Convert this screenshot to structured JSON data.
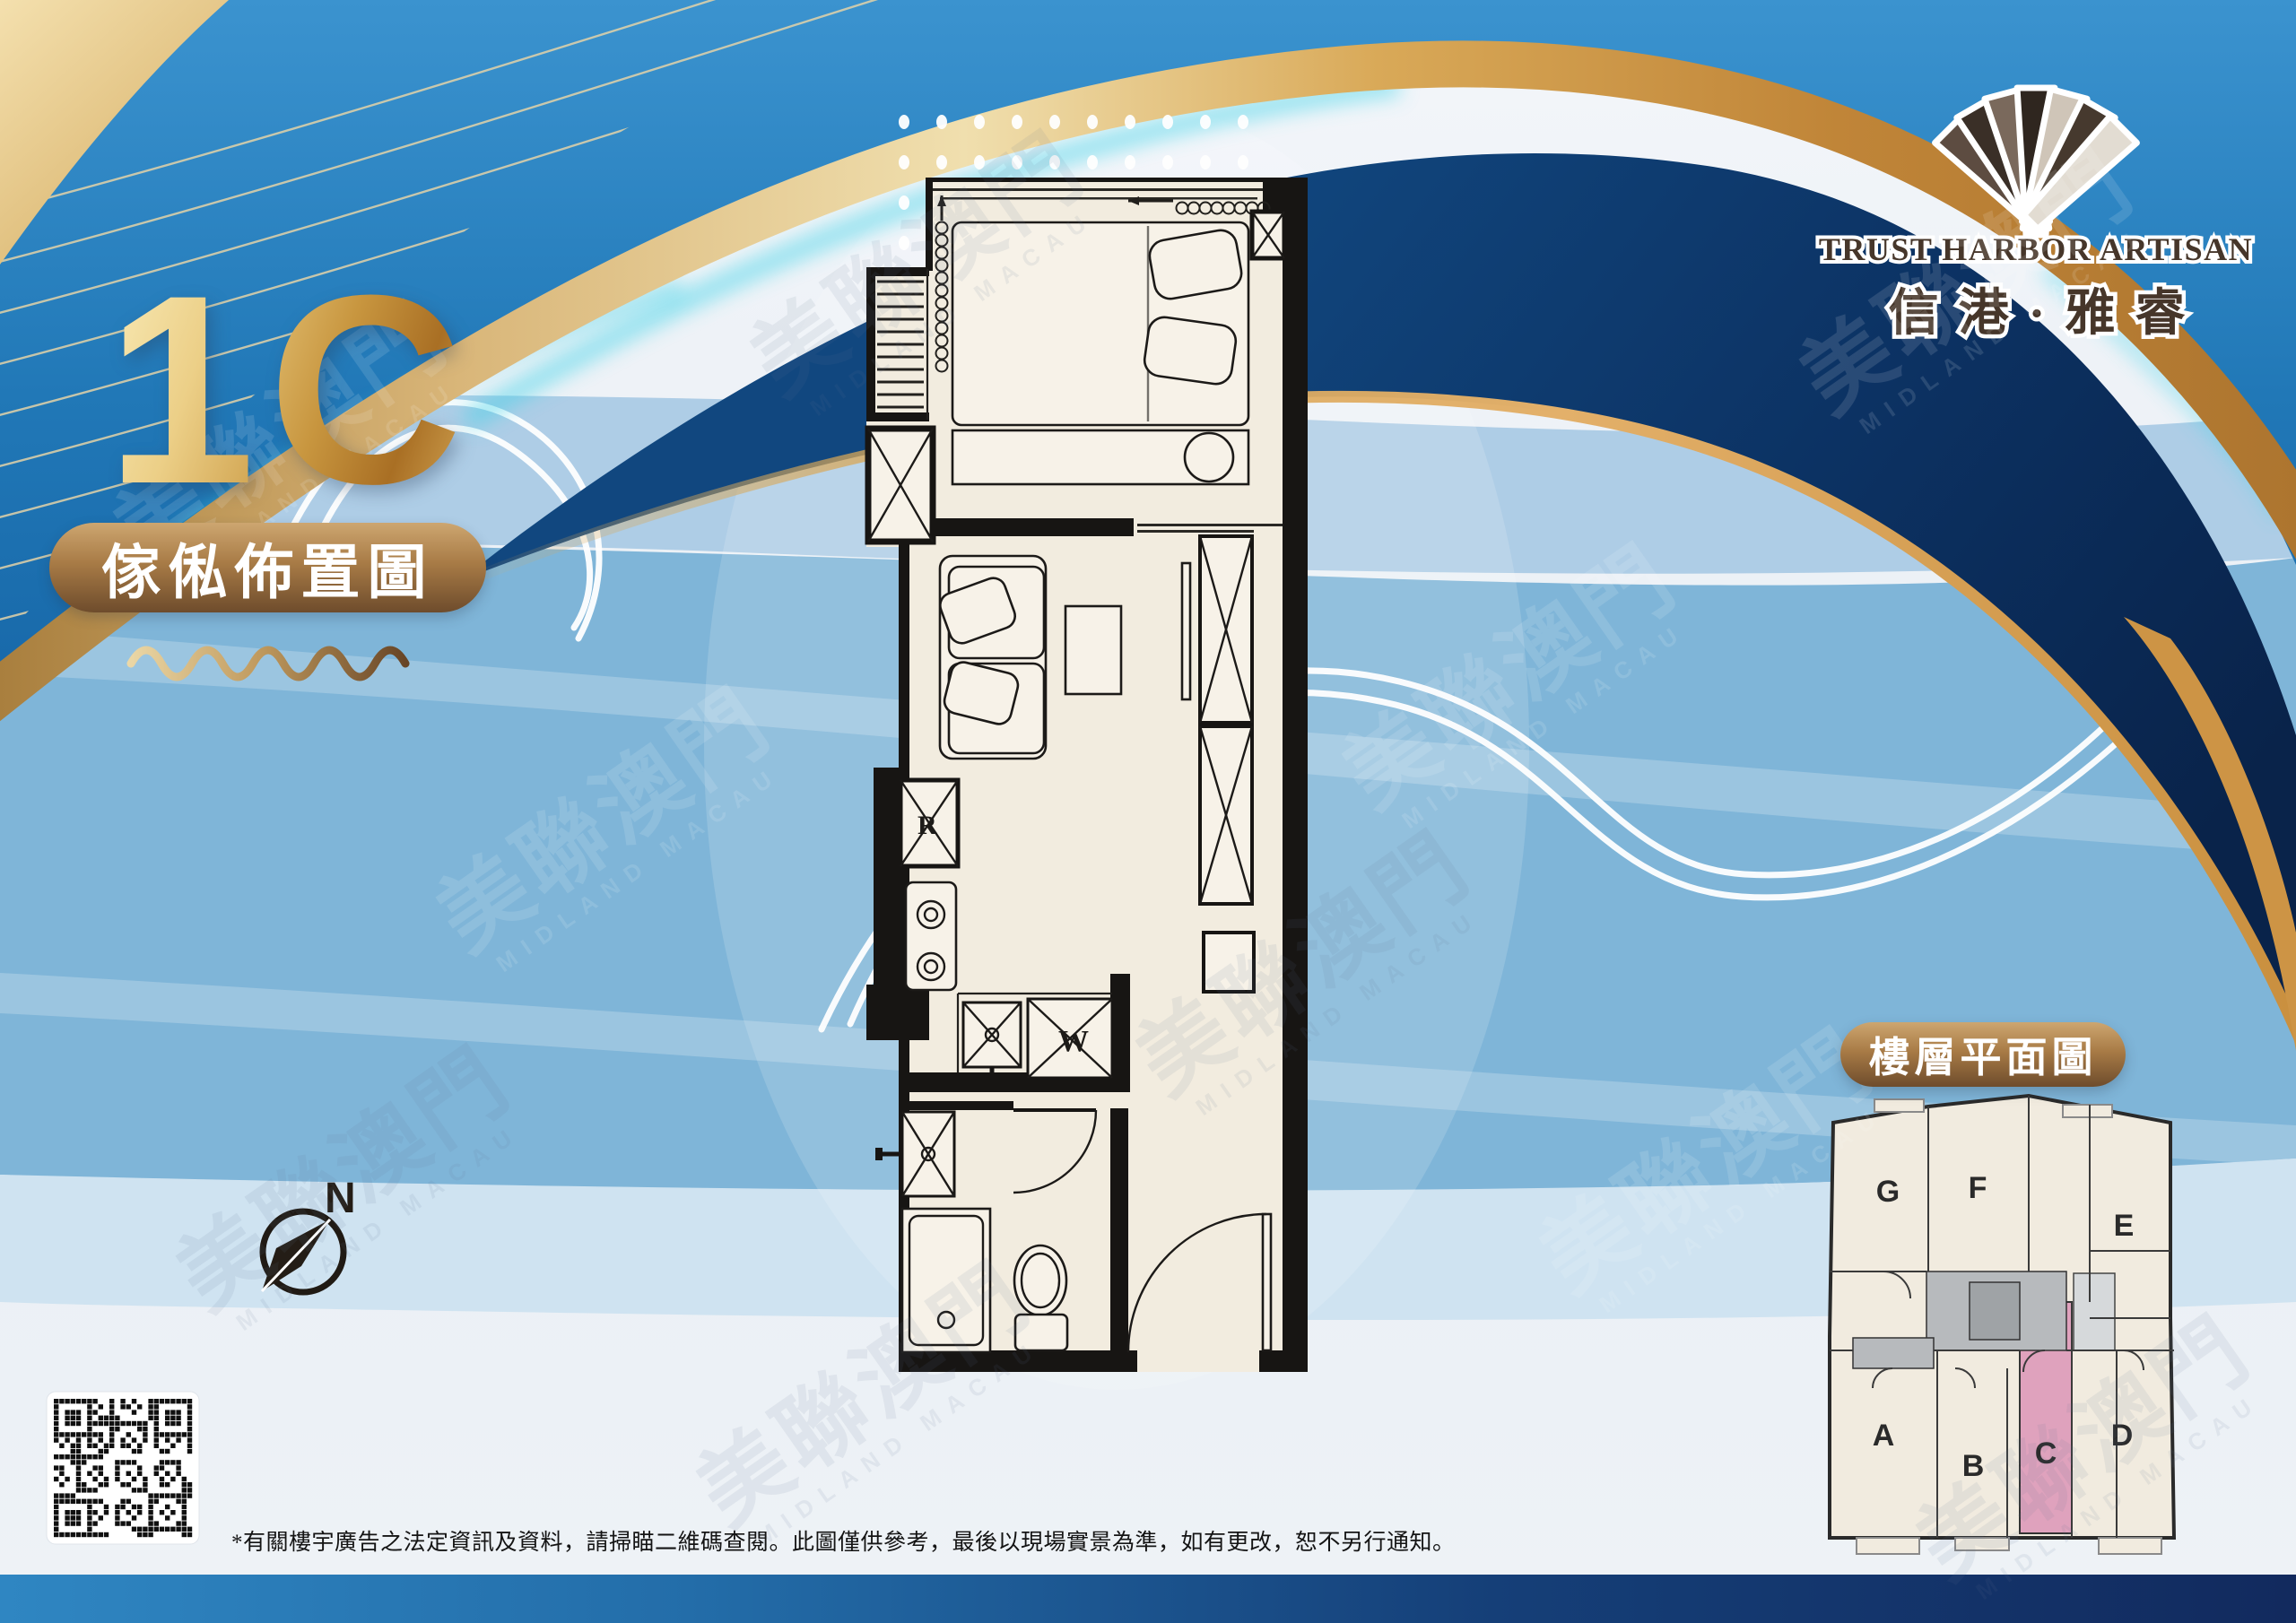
{
  "poster": {
    "unit_title": "1C",
    "furniture_badge": "傢俬佈置圖",
    "floor_plate_badge": "樓層平面圖",
    "compass_label": "N",
    "disclaimer": "*有關樓宇廣告之法定資訊及資料，請掃瞄二維碼查閱。此圖僅供參考，最後以現場實景為準，如有更改，恕不另行通知。"
  },
  "logo": {
    "name_en": "TRUST HARBOR ARTISAN",
    "name_zh": "信港·雅睿"
  },
  "floor_plan": {
    "appliance_labels": {
      "fridge": "R",
      "washer": "W"
    }
  },
  "floor_plate": {
    "units": [
      {
        "label": "G",
        "highlighted": false
      },
      {
        "label": "F",
        "highlighted": false
      },
      {
        "label": "E",
        "highlighted": false
      },
      {
        "label": "A",
        "highlighted": false
      },
      {
        "label": "B",
        "highlighted": false
      },
      {
        "label": "C",
        "highlighted": true
      },
      {
        "label": "D",
        "highlighted": false
      }
    ],
    "highlighted_unit": "C",
    "highlight_color": "#dfa2bd"
  },
  "watermark": {
    "zh": "美聯澳門",
    "en": "MIDLAND MACAU"
  },
  "colors": {
    "top_blue": "#2178b7",
    "navy": "#0c3263",
    "gold": "#d8ab63",
    "band_blue": "#7fb5d8",
    "band_light": "#aecde6",
    "badge_brown_dark": "#6e4c2c",
    "badge_brown_light": "#cda670",
    "plan_cream": "#f2ecdf",
    "footer_left": "#2f86c2",
    "footer_right": "#122a5e"
  }
}
